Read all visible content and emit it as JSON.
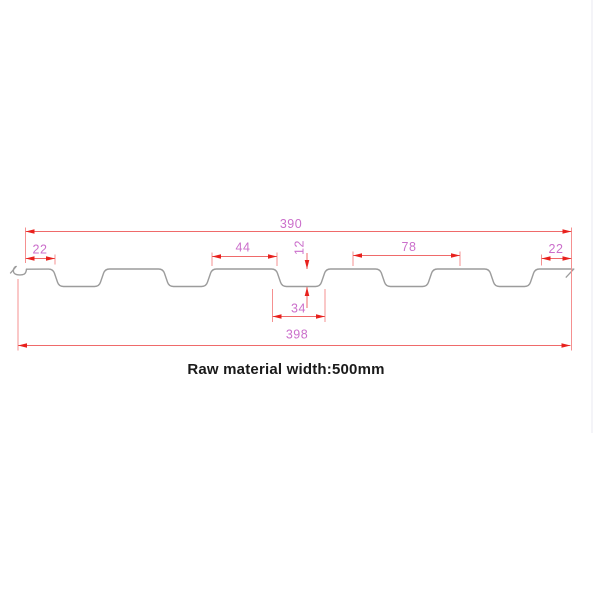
{
  "page": {
    "width": 600,
    "height": 600,
    "background": "#ffffff",
    "border_line_color": "#e9e9f0"
  },
  "title": {
    "text": "Raw material width:500mm",
    "color": "#1a1a1a"
  },
  "colors": {
    "profile_stroke": "#9c9c9c",
    "dim_line": "#ef6a6a",
    "extension_line": "#f59090",
    "arrow_fill": "#e8211d",
    "dim_text": "#cb6fcb"
  },
  "profile": {
    "description": "Cross-section of a corrugated roofing panel, 5 trapezoidal ribs",
    "y_top": 269,
    "y_bottom": 286.5,
    "corner_radius": 4.5,
    "points": [
      [
        26.5,
        269.2
      ],
      [
        53,
        269
      ],
      [
        59,
        286.5
      ],
      [
        99,
        286.5
      ],
      [
        105,
        269
      ],
      [
        163,
        269
      ],
      [
        169,
        286.5
      ],
      [
        206,
        286.5
      ],
      [
        212,
        269
      ],
      [
        276,
        269
      ],
      [
        282,
        286.5
      ],
      [
        320,
        286.5
      ],
      [
        326,
        269
      ],
      [
        380,
        269
      ],
      [
        386,
        286.5
      ],
      [
        427,
        286.5
      ],
      [
        433,
        269
      ],
      [
        489,
        269
      ],
      [
        495,
        286.5
      ],
      [
        529,
        286.5
      ],
      [
        535,
        269
      ],
      [
        572,
        269
      ]
    ],
    "left_hook_path": "M 15.4,266.6 C 12.6,269.2 12.4,273.4 16.6,274.6 C 18.2,275.1 22.4,275.1 24,274.2 C 25.6,273.4 26.3,271.2 26.5,269.2",
    "left_cut_tick": [
      10.2,
      273.4,
      16.6,
      266.0
    ],
    "right_cut_tick": [
      565.8,
      277.6,
      574.2,
      268.6
    ]
  },
  "chart_data": {
    "type": "table",
    "title": "Roof panel profile dimensions (mm)",
    "dimensions_mm": {
      "cover_width": 390,
      "overall_width": 398,
      "raw_material_width": 500,
      "edge_flat_left": 22,
      "edge_flat_right": 22,
      "crown_flat": 44,
      "rib_pitch": 78,
      "rib_bottom_width": 34,
      "rib_depth": 12
    }
  },
  "dims_h": [
    {
      "label": "390",
      "y": 231.5,
      "x1": 25.5,
      "x2": 571.5,
      "tx": 291,
      "ty": 228
    },
    {
      "label": "22",
      "y": 258.5,
      "x1": 25.5,
      "x2": 55,
      "tx": 40,
      "ty": 253.5
    },
    {
      "label": "44",
      "y": 256.5,
      "x1": 212,
      "x2": 277,
      "tx": 243,
      "ty": 251.5
    },
    {
      "label": "78",
      "y": 255.5,
      "x1": 353,
      "x2": 460,
      "tx": 409,
      "ty": 251
    },
    {
      "label": "22",
      "y": 258.5,
      "x1": 541.5,
      "x2": 571.5,
      "tx": 556,
      "ty": 253
    },
    {
      "label": "34",
      "y": 316.5,
      "x1": 272.5,
      "x2": 325,
      "tx": 298.5,
      "ty": 312.5
    },
    {
      "label": "398",
      "y": 345.5,
      "x1": 18,
      "x2": 570.5,
      "tx": 297,
      "ty": 338.5
    }
  ],
  "dims_v": [
    {
      "label": "12",
      "x": 307,
      "y1": 269,
      "y2": 287,
      "tail_top": 16,
      "tail_bottom": 21,
      "tx": 303.5,
      "ty": 247.5
    }
  ],
  "extension_lines": [
    {
      "x": 25.5,
      "y1": 227.5,
      "y2": 263
    },
    {
      "x": 571.5,
      "y1": 227.5,
      "y2": 350.5
    },
    {
      "x": 18,
      "y1": 279,
      "y2": 350.5
    },
    {
      "x": 55,
      "y1": 254.5,
      "y2": 264.5
    },
    {
      "x": 212,
      "y1": 252.5,
      "y2": 266
    },
    {
      "x": 277,
      "y1": 252.5,
      "y2": 266
    },
    {
      "x": 353,
      "y1": 251.5,
      "y2": 266
    },
    {
      "x": 460,
      "y1": 251.5,
      "y2": 266
    },
    {
      "x": 541.5,
      "y1": 254.5,
      "y2": 265.5
    },
    {
      "x": 272.5,
      "y1": 289,
      "y2": 322
    },
    {
      "x": 325,
      "y1": 289,
      "y2": 322
    }
  ],
  "border_line": {
    "x": 592,
    "y1": 0,
    "y2": 433
  }
}
